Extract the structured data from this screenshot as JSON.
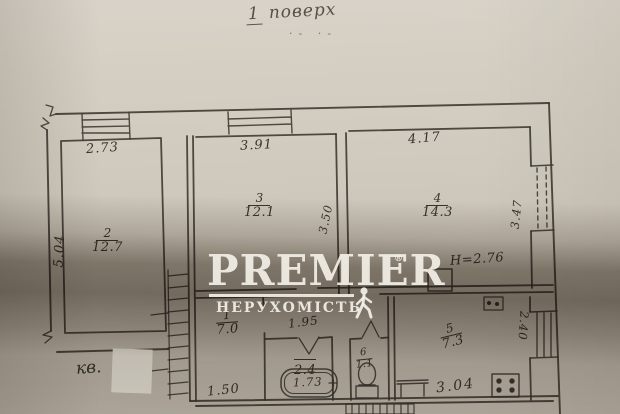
{
  "header": {
    "title_num": "1",
    "title_word": "поверх",
    "marks": "·- ·-"
  },
  "watermark": {
    "brand": "PREMIER",
    "reg": "®",
    "subtitle": "НЕРУХОМІСТЬ"
  },
  "plan": {
    "apartment_label": "кв.",
    "rooms": {
      "r1": {
        "num": "1",
        "area": "7.0"
      },
      "r2": {
        "num": "2",
        "area": "12.7"
      },
      "r3": {
        "num": "3",
        "area": "12.1"
      },
      "r4": {
        "num": "4",
        "area": "14.3"
      },
      "r5": {
        "num": "5",
        "area": "7.3"
      },
      "r6": {
        "num": "6",
        "area": "1.1"
      },
      "bath": {
        "num": "",
        "area": "2.4"
      }
    },
    "dims": {
      "room2_width": "2.73",
      "room3_width": "3.91",
      "room4_width": "4.17",
      "left_depth": "5.04",
      "inner_depth": "3.50",
      "room4_window": "3.47",
      "ceiling_height": "Н=2.76",
      "hall_width": "1.95",
      "corridor_width": "1.50",
      "bathtub_length": "1.73",
      "kitchen_width": "3.04",
      "kitchen_window": "2.40"
    }
  }
}
